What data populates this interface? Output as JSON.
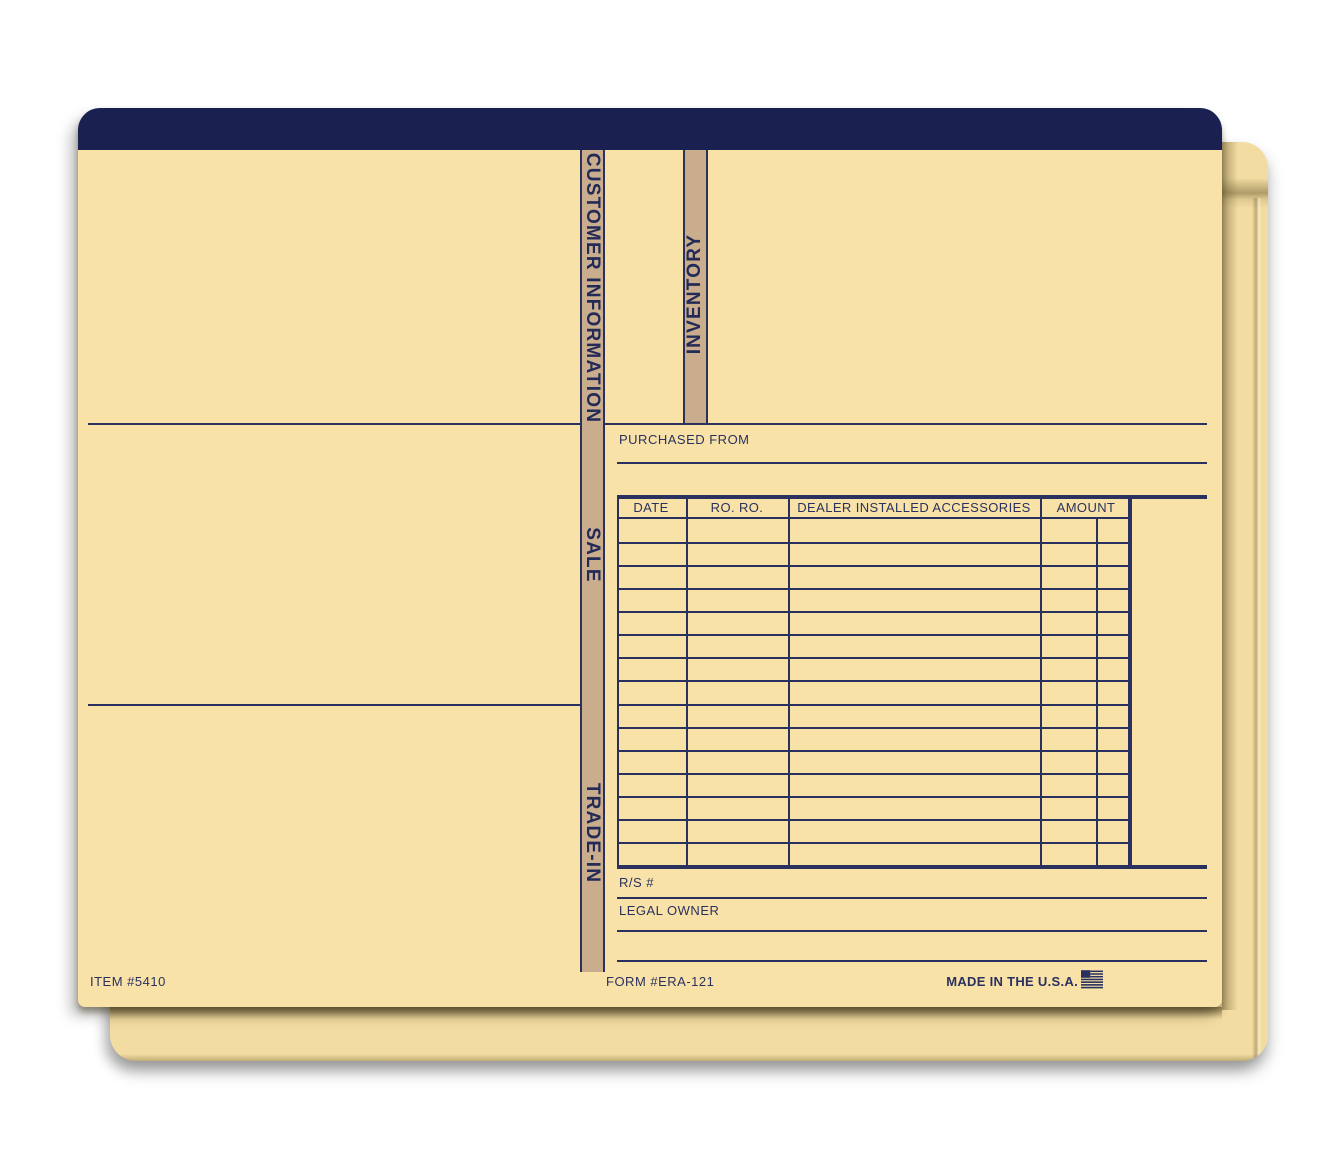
{
  "folder": {
    "navy": "#1a2050",
    "cream": "#f8e2a8",
    "back_cream": "#f3dca1",
    "tan_stripe": "#c9ad8d",
    "ink": "#2a315f"
  },
  "tabs": {
    "customer_information": "CUSTOMER INFORMATION",
    "inventory": "INVENTORY",
    "sale": "SALE",
    "trade_in": "TRADE-IN"
  },
  "labels": {
    "purchased_from": "PURCHASED FROM",
    "rs_number": "R/S #",
    "legal_owner": "LEGAL OWNER"
  },
  "table": {
    "headers": [
      "DATE",
      "RO. RO.",
      "DEALER INSTALLED ACCESSORIES",
      "AMOUNT"
    ],
    "row_count": 15
  },
  "footer": {
    "item_number": "ITEM #5410",
    "form_number": "FORM #ERA-121",
    "made_in": "MADE IN THE U.S.A."
  }
}
